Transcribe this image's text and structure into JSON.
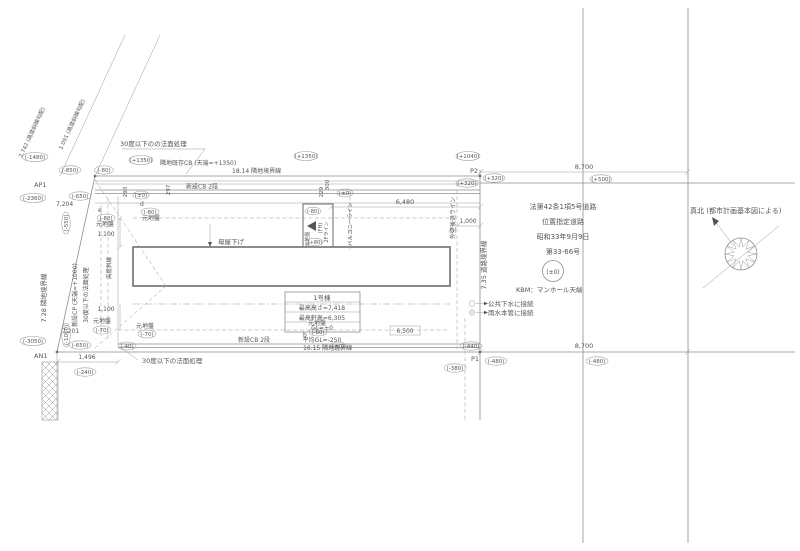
{
  "colors": {
    "background": "#ffffff",
    "line": "#8e8e8e",
    "wall": "#6f6f6f",
    "text": "#555555"
  },
  "labels": {
    "bd_top": "18.14 隣地境界線",
    "bd_bottom": "16.15 隣地境界線",
    "bd_left": "7.28 隣地境界線",
    "bd_road": "7.35 道路境界線",
    "cb_exist": "隣地既存CB (天端=+1350)",
    "cb_new_top": "新設CB 2段",
    "cb_new_btm": "新設CB 2段",
    "cp_new": "新設CP (天端=+1000)",
    "slope_top": "30度以下のの法面処理",
    "slope_btm": "30度以下の法面処理",
    "slope_left": "30度以下の法面処理",
    "diag1": "1.091 (高度斜線勾配)",
    "diag2": "2.742 (高度斜線勾配)",
    "koudo": "高度斜線",
    "p1": "P1",
    "p2": "P2",
    "ap1": "AP1",
    "an1": "AN1",
    "d8700t": "8,700",
    "d8700b": "8,700",
    "d6480": "6,480",
    "d6500": "6,500",
    "d1000": "1,000",
    "d1100a": "1,100",
    "d1100b": "1,100",
    "d1496": "1,496",
    "d7204": "7,204",
    "d7201": "7,201",
    "d293": "293",
    "d297": "297",
    "d300": "300",
    "d229": "229",
    "moyasage": "母屋下げ",
    "fh": "(FH)",
    "f2line": "2Fライン",
    "balcony": "バルコニーライン",
    "setback": "外壁後退ライン",
    "gen_e": "元地盤",
    "gen_d": "元地盤",
    "gen_f": "元地盤",
    "gen_a": "元地盤",
    "gen_b": "元地盤",
    "gen_box": "元地盤",
    "pt_e": "e",
    "pt_d": "d",
    "pt_b": "b",
    "bld_name": "1号棟",
    "bld_h1": "最高高さ=7,418",
    "bld_h2": "最高軒高=6,305",
    "bld_gl": "GL=±0",
    "bld_avg": "平均GL=-250",
    "road1": "法第42条1項5号道路",
    "road2": "位置指定道路",
    "road3": "昭和33年9月9日",
    "road4": "第33-66号",
    "kbm": "KBM：マンホール天端",
    "leg1": "公共下水に接続",
    "leg2": "雨水本管に接続",
    "north": "真北 (都市計画基本図による)",
    "v1480": "(-1480)",
    "v2360": "(-2360)",
    "v3050": "(-3050)",
    "v850": "(-850)",
    "v80top": "(-80)",
    "v1350a": "(+1350)",
    "v1350b": "(+1350)",
    "v1040": "(+1040)",
    "v650a": "(-650)",
    "v650b": "(-650)",
    "v550": "(-550)",
    "v1050": "(-1050)",
    "v320a": "(+320)",
    "v320b": "(+320)",
    "v500": "(+500)",
    "v440": "(-440)",
    "v480a": "(-480)",
    "v480b": "(-480)",
    "v380": "(-380)",
    "v240": "(-240)",
    "vpm0a": "(±0)",
    "vpm0b": "(±0)",
    "vpm0c": "(±0)",
    "v40": "(-40)",
    "v80e": "(-80)",
    "v80d": "(-80)",
    "v70f": "(-70)",
    "v70a": "(-70)",
    "v80b": "(-80)",
    "v80c": "(-80)",
    "v80p": "(+80)",
    "vkbm": "(±0)"
  }
}
